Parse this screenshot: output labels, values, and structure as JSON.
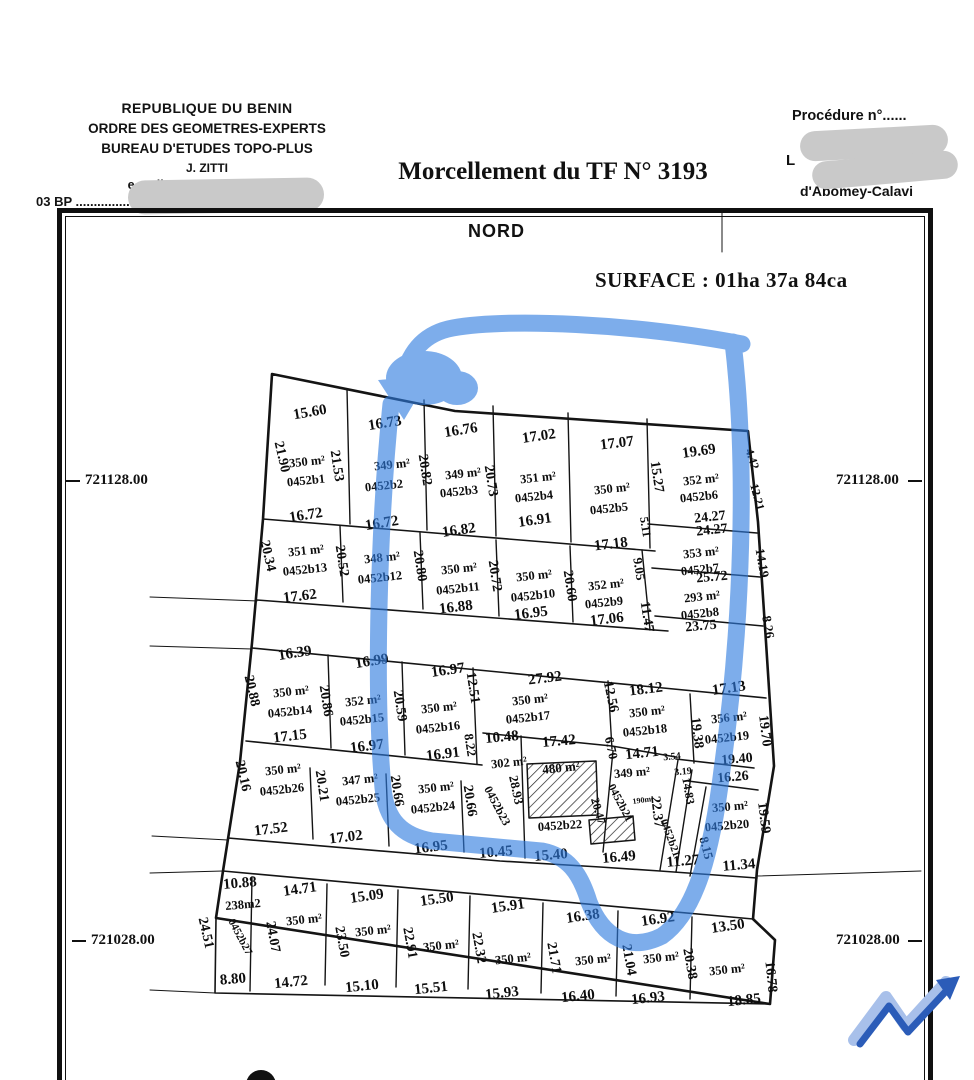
{
  "header": {
    "org_lines": [
      "REPUBLIQUE DU BENIN",
      "ORDRE DES GEOMETRES-EXPERTS",
      "BUREAU D'ETUDES TOPO-PLUS",
      "J. ZITTI",
      "e-mail: z..........@gmail.com",
      "03 BP .......................... S Cotonou"
    ],
    "title": "Morcellement du TF N° 3193",
    "procedure_label": "Procédure n°......",
    "location_partial_1": "L",
    "location_partial_2": "d'Abomey-Calavi"
  },
  "map": {
    "north_label": "NORD",
    "surface_label": "SURFACE : 01ha 37a  84ca",
    "coordinates": {
      "left_top": "721128.00",
      "right_top": "721128.00",
      "left_bottom": "721028.00",
      "right_bottom": "721028.00"
    },
    "highlight_color": "#2f7ce0",
    "logo_colors": {
      "light": "#a8c0ea",
      "dark": "#2b5cb8"
    },
    "labels": [
      {
        "t": "15.60",
        "x": 310,
        "y": 413,
        "r": -10,
        "f": 15
      },
      {
        "t": "16.73",
        "x": 385,
        "y": 424,
        "r": -9,
        "f": 15
      },
      {
        "t": "16.76",
        "x": 461,
        "y": 431,
        "r": -9,
        "f": 15
      },
      {
        "t": "17.02",
        "x": 539,
        "y": 437,
        "r": -8,
        "f": 15
      },
      {
        "t": "17.07",
        "x": 617,
        "y": 444,
        "r": -7,
        "f": 15
      },
      {
        "t": "19.69",
        "x": 699,
        "y": 452,
        "r": -8,
        "f": 15
      },
      {
        "t": "21.90",
        "x": 281,
        "y": 457,
        "r": 77
      },
      {
        "t": "21.53",
        "x": 336,
        "y": 466,
        "r": 81
      },
      {
        "t": "20.82",
        "x": 424,
        "y": 470,
        "r": 81
      },
      {
        "t": "20.73",
        "x": 490,
        "y": 481,
        "r": 81
      },
      {
        "t": "15.27",
        "x": 656,
        "y": 477,
        "r": 81
      },
      {
        "t": "5.11",
        "x": 645,
        "y": 527,
        "r": 81,
        "f": 12
      },
      {
        "t": "350 m²",
        "x": 307,
        "y": 462,
        "r": -6,
        "f": 12.5
      },
      {
        "t": "0452b1",
        "x": 306,
        "y": 481,
        "r": -6,
        "f": 12.5
      },
      {
        "t": "349 m²",
        "x": 392,
        "y": 465,
        "r": -6,
        "f": 12.5
      },
      {
        "t": "0452b2",
        "x": 384,
        "y": 486,
        "r": -6,
        "f": 12.5
      },
      {
        "t": "349 m²",
        "x": 463,
        "y": 474,
        "r": -6,
        "f": 12.5
      },
      {
        "t": "0452b3",
        "x": 459,
        "y": 492,
        "r": -6,
        "f": 12.5
      },
      {
        "t": "351 m²",
        "x": 538,
        "y": 478,
        "r": -6,
        "f": 12.5
      },
      {
        "t": "0452b4",
        "x": 534,
        "y": 497,
        "r": -6,
        "f": 12.5
      },
      {
        "t": "350 m²",
        "x": 612,
        "y": 489,
        "r": -6,
        "f": 12.5
      },
      {
        "t": "0452b5",
        "x": 609,
        "y": 509,
        "r": -6,
        "f": 12.5
      },
      {
        "t": "352 m²",
        "x": 701,
        "y": 480,
        "r": -6,
        "f": 12.5
      },
      {
        "t": "0452b6",
        "x": 699,
        "y": 497,
        "r": -6,
        "f": 12.5
      },
      {
        "t": "24.27",
        "x": 710,
        "y": 518,
        "r": -6
      },
      {
        "t": "24.27",
        "x": 712,
        "y": 531,
        "r": -6
      },
      {
        "t": "4.42",
        "x": 752,
        "y": 459,
        "r": 72,
        "f": 12
      },
      {
        "t": "12.21",
        "x": 757,
        "y": 497,
        "r": 75,
        "f": 12
      },
      {
        "t": "14.19",
        "x": 762,
        "y": 563,
        "r": 80,
        "f": 13
      },
      {
        "t": "8.26",
        "x": 768,
        "y": 627,
        "r": 80,
        "f": 13
      },
      {
        "t": "16.72",
        "x": 306,
        "y": 516,
        "r": -9,
        "f": 15
      },
      {
        "t": "16.72",
        "x": 382,
        "y": 524,
        "r": -9,
        "f": 15
      },
      {
        "t": "16.82",
        "x": 459,
        "y": 531,
        "r": -8,
        "f": 15
      },
      {
        "t": "16.91",
        "x": 535,
        "y": 521,
        "r": -8,
        "f": 15
      },
      {
        "t": "17.18",
        "x": 611,
        "y": 545,
        "r": -7,
        "f": 15
      },
      {
        "t": "20.34",
        "x": 267,
        "y": 556,
        "r": 77
      },
      {
        "t": "20.52",
        "x": 341,
        "y": 561,
        "r": 81
      },
      {
        "t": "20.80",
        "x": 419,
        "y": 566,
        "r": 81
      },
      {
        "t": "20.72",
        "x": 494,
        "y": 576,
        "r": 81
      },
      {
        "t": "20.60",
        "x": 569,
        "y": 586,
        "r": 81
      },
      {
        "t": "9.05",
        "x": 639,
        "y": 569,
        "r": 81,
        "f": 13
      },
      {
        "t": "11.47",
        "x": 646,
        "y": 617,
        "r": 81
      },
      {
        "t": "351 m²",
        "x": 306,
        "y": 551,
        "r": -6,
        "f": 12.5
      },
      {
        "t": "0452b13",
        "x": 305,
        "y": 570,
        "r": -6,
        "f": 12.5
      },
      {
        "t": "348 m²",
        "x": 382,
        "y": 558,
        "r": -6,
        "f": 12.5
      },
      {
        "t": "0452b12",
        "x": 380,
        "y": 578,
        "r": -6,
        "f": 12.5
      },
      {
        "t": "350 m²",
        "x": 459,
        "y": 569,
        "r": -6,
        "f": 12.5
      },
      {
        "t": "0452b11",
        "x": 458,
        "y": 589,
        "r": -6,
        "f": 12.5
      },
      {
        "t": "350 m²",
        "x": 534,
        "y": 576,
        "r": -6,
        "f": 12.5
      },
      {
        "t": "0452b10",
        "x": 533,
        "y": 596,
        "r": -6,
        "f": 12.5
      },
      {
        "t": "352 m²",
        "x": 606,
        "y": 585,
        "r": -6,
        "f": 12.5
      },
      {
        "t": "0452b9",
        "x": 604,
        "y": 603,
        "r": -6,
        "f": 12.5
      },
      {
        "t": "353 m²",
        "x": 701,
        "y": 553,
        "r": -6,
        "f": 12.5
      },
      {
        "t": "0452b7",
        "x": 700,
        "y": 570,
        "r": -6,
        "f": 12.5
      },
      {
        "t": "25.72",
        "x": 712,
        "y": 578,
        "r": -5
      },
      {
        "t": "293 m²",
        "x": 702,
        "y": 597,
        "r": -6,
        "f": 12.5
      },
      {
        "t": "0452b8",
        "x": 700,
        "y": 614,
        "r": -6,
        "f": 12.5
      },
      {
        "t": "23.75",
        "x": 701,
        "y": 627,
        "r": -5
      },
      {
        "t": "17.62",
        "x": 300,
        "y": 597,
        "r": -7,
        "f": 15
      },
      {
        "t": "16.88",
        "x": 456,
        "y": 608,
        "r": -7,
        "f": 15
      },
      {
        "t": "16.95",
        "x": 531,
        "y": 614,
        "r": -7,
        "f": 15
      },
      {
        "t": "17.06",
        "x": 607,
        "y": 620,
        "r": -7,
        "f": 15
      },
      {
        "t": "16.39",
        "x": 295,
        "y": 654,
        "r": -9,
        "f": 15
      },
      {
        "t": "16.99",
        "x": 372,
        "y": 662,
        "r": -9,
        "f": 15
      },
      {
        "t": "16.97",
        "x": 448,
        "y": 671,
        "r": -8,
        "f": 15
      },
      {
        "t": "27.92",
        "x": 545,
        "y": 679,
        "r": -7,
        "f": 15
      },
      {
        "t": "18.12",
        "x": 646,
        "y": 690,
        "r": -7,
        "f": 15
      },
      {
        "t": "17.13",
        "x": 729,
        "y": 689,
        "r": -8,
        "f": 15
      },
      {
        "t": "20.88",
        "x": 251,
        "y": 691,
        "r": 77
      },
      {
        "t": "20.86",
        "x": 325,
        "y": 701,
        "r": 81
      },
      {
        "t": "20.59",
        "x": 399,
        "y": 706,
        "r": 81
      },
      {
        "t": "12.51",
        "x": 472,
        "y": 688,
        "r": 81
      },
      {
        "t": "12.56",
        "x": 610,
        "y": 697,
        "r": 78
      },
      {
        "t": "19.38",
        "x": 696,
        "y": 733,
        "r": 83
      },
      {
        "t": "19.70",
        "x": 764,
        "y": 731,
        "r": 83
      },
      {
        "t": "350 m²",
        "x": 291,
        "y": 692,
        "r": -6,
        "f": 12.5
      },
      {
        "t": "0452b14",
        "x": 290,
        "y": 712,
        "r": -6,
        "f": 12.5
      },
      {
        "t": "352 m²",
        "x": 363,
        "y": 701,
        "r": -6,
        "f": 12.5
      },
      {
        "t": "0452b15",
        "x": 362,
        "y": 720,
        "r": -6,
        "f": 12.5
      },
      {
        "t": "350 m²",
        "x": 439,
        "y": 708,
        "r": -6,
        "f": 12.5
      },
      {
        "t": "0452b16",
        "x": 438,
        "y": 728,
        "r": -6,
        "f": 12.5
      },
      {
        "t": "350 m²",
        "x": 530,
        "y": 700,
        "r": -6,
        "f": 12.5
      },
      {
        "t": "0452b17",
        "x": 528,
        "y": 718,
        "r": -6,
        "f": 12.5
      },
      {
        "t": "350 m²",
        "x": 647,
        "y": 712,
        "r": -6,
        "f": 12.5
      },
      {
        "t": "0452b18",
        "x": 645,
        "y": 731,
        "r": -6,
        "f": 12.5
      },
      {
        "t": "356 m²",
        "x": 729,
        "y": 718,
        "r": -6,
        "f": 12.5
      },
      {
        "t": "0452b19",
        "x": 727,
        "y": 738,
        "r": -6,
        "f": 12.5
      },
      {
        "t": "17.15",
        "x": 290,
        "y": 737,
        "r": -7,
        "f": 15
      },
      {
        "t": "16.97",
        "x": 367,
        "y": 747,
        "r": -7,
        "f": 15
      },
      {
        "t": "16.91",
        "x": 443,
        "y": 755,
        "r": -7,
        "f": 15
      },
      {
        "t": "8.22",
        "x": 470,
        "y": 745,
        "r": 81,
        "f": 13
      },
      {
        "t": "10.48",
        "x": 502,
        "y": 738,
        "r": -5,
        "f": 15
      },
      {
        "t": "17.42",
        "x": 559,
        "y": 742,
        "r": -5,
        "f": 15
      },
      {
        "t": "6.70",
        "x": 611,
        "y": 748,
        "r": 78,
        "f": 13
      },
      {
        "t": "14.71",
        "x": 642,
        "y": 754,
        "r": -6,
        "f": 15
      },
      {
        "t": "3.54",
        "x": 672,
        "y": 757,
        "r": -6,
        "f": 10
      },
      {
        "t": "19.40",
        "x": 737,
        "y": 760,
        "r": -5
      },
      {
        "t": "302 m²",
        "x": 509,
        "y": 763,
        "r": -6,
        "f": 12.5
      },
      {
        "t": "480 m²",
        "x": 561,
        "y": 768,
        "r": -6,
        "f": 13
      },
      {
        "t": "20.16",
        "x": 242,
        "y": 776,
        "r": 77
      },
      {
        "t": "350 m²",
        "x": 283,
        "y": 770,
        "r": -6,
        "f": 12.5
      },
      {
        "t": "0452b26",
        "x": 282,
        "y": 790,
        "r": -6,
        "f": 12.5
      },
      {
        "t": "20.21",
        "x": 321,
        "y": 786,
        "r": 81
      },
      {
        "t": "347 m²",
        "x": 360,
        "y": 780,
        "r": -6,
        "f": 12.5
      },
      {
        "t": "0452b25",
        "x": 358,
        "y": 800,
        "r": -6,
        "f": 12.5
      },
      {
        "t": "20.66",
        "x": 396,
        "y": 791,
        "r": 81
      },
      {
        "t": "350 m²",
        "x": 436,
        "y": 788,
        "r": -6,
        "f": 12.5
      },
      {
        "t": "0452b24",
        "x": 433,
        "y": 808,
        "r": -6,
        "f": 12.5
      },
      {
        "t": "20.66",
        "x": 469,
        "y": 801,
        "r": 81
      },
      {
        "t": "0452b23",
        "x": 497,
        "y": 806,
        "r": 62,
        "f": 12
      },
      {
        "t": "28.93",
        "x": 516,
        "y": 790,
        "r": 78,
        "f": 13
      },
      {
        "t": "0452b22",
        "x": 560,
        "y": 826,
        "r": -4,
        "f": 12.5
      },
      {
        "t": "349 m²",
        "x": 632,
        "y": 773,
        "r": -5,
        "f": 12.5
      },
      {
        "t": "3.19",
        "x": 683,
        "y": 772,
        "r": -5,
        "f": 10
      },
      {
        "t": "16.26",
        "x": 733,
        "y": 778,
        "r": -5
      },
      {
        "t": "0452b21",
        "x": 620,
        "y": 803,
        "r": 62,
        "f": 11.5
      },
      {
        "t": "20.47",
        "x": 598,
        "y": 811,
        "r": 74,
        "f": 12
      },
      {
        "t": "22.37",
        "x": 656,
        "y": 812,
        "r": 83
      },
      {
        "t": "14.83",
        "x": 688,
        "y": 791,
        "r": 80,
        "f": 12
      },
      {
        "t": "190m²",
        "x": 643,
        "y": 800,
        "r": -8,
        "f": 8
      },
      {
        "t": "350 m²",
        "x": 730,
        "y": 807,
        "r": -5,
        "f": 12.5
      },
      {
        "t": "0452b20",
        "x": 727,
        "y": 826,
        "r": -5,
        "f": 12.5
      },
      {
        "t": "19.59",
        "x": 763,
        "y": 818,
        "r": 83
      },
      {
        "t": "0452b21",
        "x": 670,
        "y": 838,
        "r": 70,
        "f": 11
      },
      {
        "t": "8.15",
        "x": 706,
        "y": 848,
        "r": 75,
        "f": 13
      },
      {
        "t": "17.52",
        "x": 271,
        "y": 830,
        "r": -7,
        "f": 15
      },
      {
        "t": "17.02",
        "x": 346,
        "y": 838,
        "r": -7,
        "f": 15
      },
      {
        "t": "16.95",
        "x": 431,
        "y": 848,
        "r": -7,
        "f": 15
      },
      {
        "t": "10.45",
        "x": 496,
        "y": 853,
        "r": -5,
        "f": 15
      },
      {
        "t": "15.40",
        "x": 551,
        "y": 856,
        "r": -5,
        "f": 15
      },
      {
        "t": "16.49",
        "x": 619,
        "y": 858,
        "r": -5,
        "f": 15
      },
      {
        "t": "11.27",
        "x": 683,
        "y": 862,
        "r": -5,
        "f": 15
      },
      {
        "t": "11.34",
        "x": 739,
        "y": 866,
        "r": -5,
        "f": 15
      },
      {
        "t": "10.88",
        "x": 240,
        "y": 884,
        "r": -5,
        "f": 15
      },
      {
        "t": "14.71",
        "x": 300,
        "y": 890,
        "r": -8,
        "f": 15
      },
      {
        "t": "15.09",
        "x": 367,
        "y": 897,
        "r": -8,
        "f": 15
      },
      {
        "t": "15.50",
        "x": 437,
        "y": 900,
        "r": -8,
        "f": 15
      },
      {
        "t": "15.91",
        "x": 508,
        "y": 907,
        "r": -8,
        "f": 15
      },
      {
        "t": "16.38",
        "x": 583,
        "y": 917,
        "r": -8,
        "f": 15
      },
      {
        "t": "16.92",
        "x": 658,
        "y": 920,
        "r": -8,
        "f": 15
      },
      {
        "t": "13.50",
        "x": 728,
        "y": 927,
        "r": -8,
        "f": 15
      },
      {
        "t": "238m2",
        "x": 243,
        "y": 905,
        "r": -5,
        "f": 12.5
      },
      {
        "t": "0452b27",
        "x": 240,
        "y": 937,
        "r": 62,
        "f": 11
      },
      {
        "t": "24.51",
        "x": 205,
        "y": 933,
        "r": 77
      },
      {
        "t": "350 m²",
        "x": 304,
        "y": 920,
        "r": -6,
        "f": 12.5
      },
      {
        "t": "24.07",
        "x": 272,
        "y": 937,
        "r": 80
      },
      {
        "t": "350 m²",
        "x": 373,
        "y": 931,
        "r": -6,
        "f": 12.5
      },
      {
        "t": "23.50",
        "x": 341,
        "y": 942,
        "r": 80
      },
      {
        "t": "350 m²",
        "x": 441,
        "y": 946,
        "r": -6,
        "f": 12.5
      },
      {
        "t": "22.91",
        "x": 409,
        "y": 943,
        "r": 80
      },
      {
        "t": "350 m²",
        "x": 513,
        "y": 959,
        "r": -6,
        "f": 12.5
      },
      {
        "t": "22.32",
        "x": 478,
        "y": 948,
        "r": 80
      },
      {
        "t": "350 m²",
        "x": 593,
        "y": 960,
        "r": -6,
        "f": 12.5
      },
      {
        "t": "21.71",
        "x": 553,
        "y": 958,
        "r": 80
      },
      {
        "t": "350 m²",
        "x": 661,
        "y": 958,
        "r": -6,
        "f": 12.5
      },
      {
        "t": "21.04",
        "x": 628,
        "y": 960,
        "r": 80
      },
      {
        "t": "350 m²",
        "x": 727,
        "y": 970,
        "r": -6,
        "f": 12.5
      },
      {
        "t": "20.38",
        "x": 689,
        "y": 964,
        "r": 80
      },
      {
        "t": "16.78",
        "x": 770,
        "y": 977,
        "r": 84
      },
      {
        "t": "8.80",
        "x": 233,
        "y": 980,
        "r": -5,
        "f": 15
      },
      {
        "t": "14.72",
        "x": 291,
        "y": 983,
        "r": -6,
        "f": 15
      },
      {
        "t": "15.10",
        "x": 362,
        "y": 987,
        "r": -6,
        "f": 15
      },
      {
        "t": "15.51",
        "x": 431,
        "y": 989,
        "r": -6,
        "f": 15
      },
      {
        "t": "15.93",
        "x": 502,
        "y": 994,
        "r": -6,
        "f": 15
      },
      {
        "t": "16.40",
        "x": 578,
        "y": 997,
        "r": -6,
        "f": 15
      },
      {
        "t": "16.93",
        "x": 648,
        "y": 999,
        "r": -6,
        "f": 15
      },
      {
        "t": "18.85",
        "x": 744,
        "y": 1001,
        "r": -6,
        "f": 15
      }
    ]
  }
}
